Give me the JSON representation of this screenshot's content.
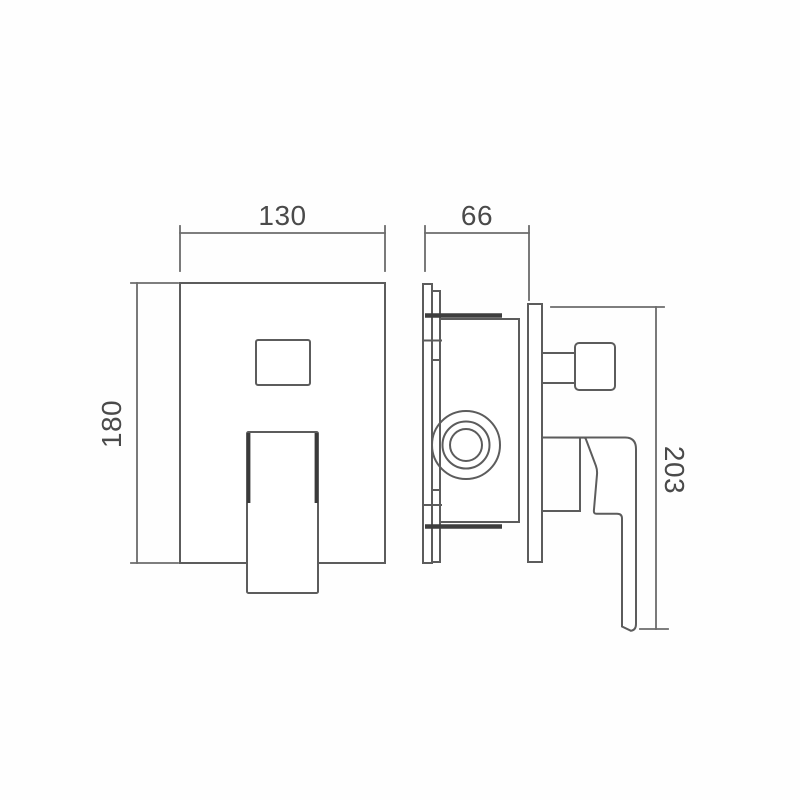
{
  "drawing": {
    "type": "technical-dimension-drawing",
    "views": {
      "front": "front view of square shower mixer wall plate with diverter window and lever handle",
      "side": "side profile view with in-wall valve body, mounting flange, wall plate, diverter knob and lever"
    }
  },
  "dimensions": {
    "front_plate_width": "130",
    "depth": "66",
    "front_plate_height": "180",
    "overall_height": "203"
  },
  "colors": {
    "background": "#fefefe",
    "line": "#5c5c5c",
    "line_bold": "#3e3e3e",
    "dimension_line": "#6b6b6b",
    "text": "#4a4a4a"
  }
}
